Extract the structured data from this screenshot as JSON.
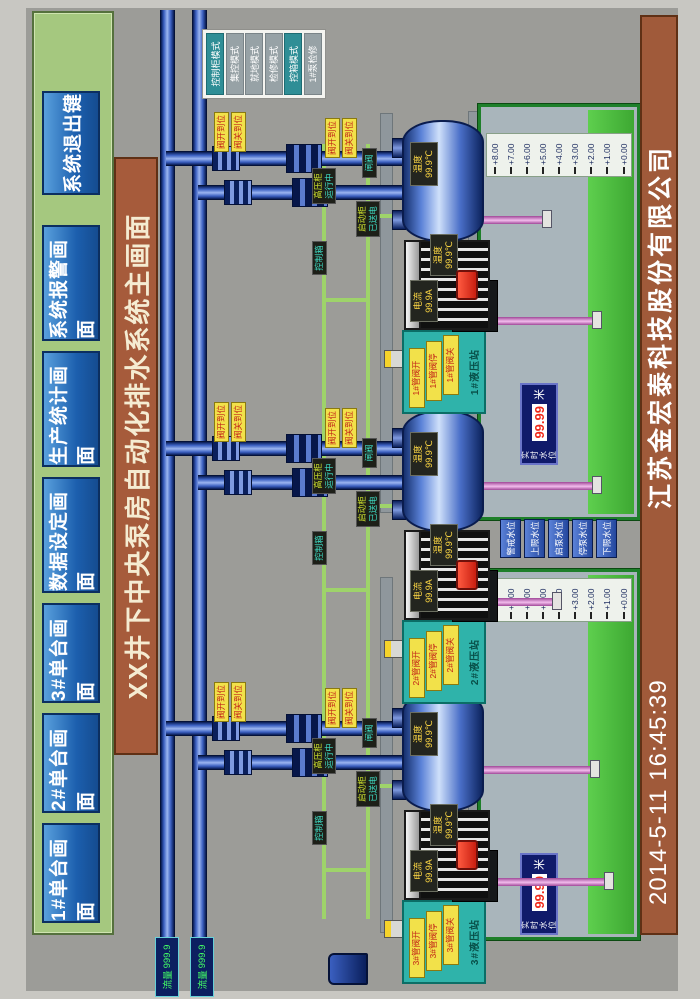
{
  "title": "XX井下中央泵房自动化排水系统主画面",
  "menu": {
    "buttons": [
      "1#单台画面",
      "2#单台画面",
      "3#单台画面",
      "数据设定画面",
      "生产统计画面",
      "系统报警画面",
      "系统退出键"
    ]
  },
  "mode_panel": {
    "items": [
      "控制柜模式",
      "集控模式",
      "就地模式",
      "检修模式",
      "控箱模式",
      "1#泵检修"
    ]
  },
  "flow_readouts": [
    {
      "label": "流量",
      "value": "999.9"
    },
    {
      "label": "流量",
      "value": "999.9"
    }
  ],
  "clusters": [
    {
      "id": "3#",
      "hydraulic": {
        "title": "3#液压站",
        "buttons": [
          "3#管阀开",
          "3#管阀停",
          "3#管阀关"
        ]
      },
      "pump_label": {
        "l1": "温度",
        "l2": "99.9℃"
      },
      "motor_temp": {
        "l1": "温度",
        "l2": "99.9℃"
      },
      "motor_current": {
        "l1": "电流",
        "l2": "99.9A"
      },
      "cabinet_a": {
        "label": "高压柜",
        "status": "运行中"
      },
      "cabinet_b": {
        "label": "启动柜",
        "status": "已送电"
      },
      "cabinet_c": "控制箱",
      "valve_tag": "闸阀",
      "limit_tags_a": [
        "阀开到位",
        "阀关到位"
      ],
      "limit_tags_b": [
        "阀开到位",
        "阀关到位"
      ]
    },
    {
      "id": "2#",
      "hydraulic": {
        "title": "2#液压站",
        "buttons": [
          "2#管阀开",
          "2#管阀停",
          "2#管阀关"
        ]
      },
      "pump_label": {
        "l1": "温度",
        "l2": "99.9℃"
      },
      "motor_temp": {
        "l1": "温度",
        "l2": "99.9℃"
      },
      "motor_current": {
        "l1": "电流",
        "l2": "99.9A"
      },
      "cabinet_a": {
        "label": "高压柜",
        "status": "运行中"
      },
      "cabinet_b": {
        "label": "启动柜",
        "status": "已送电"
      },
      "cabinet_c": "控制箱",
      "valve_tag": "闸阀",
      "limit_tags_a": [
        "阀开到位",
        "阀关到位"
      ],
      "limit_tags_b": [
        "阀开到位",
        "阀关到位"
      ]
    },
    {
      "id": "1#",
      "hydraulic": {
        "title": "1#液压站",
        "buttons": [
          "1#管阀开",
          "1#管阀停",
          "1#管阀关"
        ]
      },
      "pump_label": {
        "l1": "温度",
        "l2": "99.9℃"
      },
      "motor_temp": {
        "l1": "温度",
        "l2": "99.9℃"
      },
      "motor_current": {
        "l1": "电流",
        "l2": "99.9A"
      },
      "cabinet_a": {
        "label": "高压柜",
        "status": "运行中"
      },
      "cabinet_b": {
        "label": "启动柜",
        "status": "已送电"
      },
      "cabinet_c": "控制箱",
      "valve_tag": "闸阀",
      "limit_tags_a": [
        "阀开到位",
        "阀关到位"
      ],
      "limit_tags_b": [
        "阀开到位",
        "阀关到位"
      ]
    }
  ],
  "tanks": [
    {
      "scale": [
        "+8.00",
        "+7.00",
        "+6.00",
        "+5.00",
        "+4.00",
        "+3.00",
        "+2.00",
        "+1.00",
        "+0.00"
      ],
      "readout": {
        "l1": "实时",
        "l2": "水位",
        "value": "99.99",
        "unit": "米"
      }
    },
    {
      "scale": [
        "+8.00",
        "+7.00",
        "+6.00",
        "+5.00",
        "+4.00",
        "+3.00",
        "+2.00",
        "+1.00",
        "+0.00"
      ],
      "readout": {
        "l1": "实时",
        "l2": "水位",
        "value": "99.99",
        "unit": "米"
      }
    }
  ],
  "level_buttons": [
    "警戒水位",
    "上限水位",
    "启泵水位",
    "停泵水位",
    "下限水位"
  ],
  "footer": {
    "datetime": "2014-5-11  16:45:39",
    "company": "江苏金宏泰科技股份有限公司"
  },
  "colors": {
    "menu_green": "#a5c87f",
    "button_blue": "#1c5fae",
    "banner_brown": "#a65b3b",
    "mode_teal": "#2f8e96",
    "alarm_yellow": "#f2e14a",
    "water_green": "#4dbf40",
    "pipe_navy": "#0a1f5c",
    "suction_pink": "#e8a8e0",
    "value_red": "#f02818"
  }
}
